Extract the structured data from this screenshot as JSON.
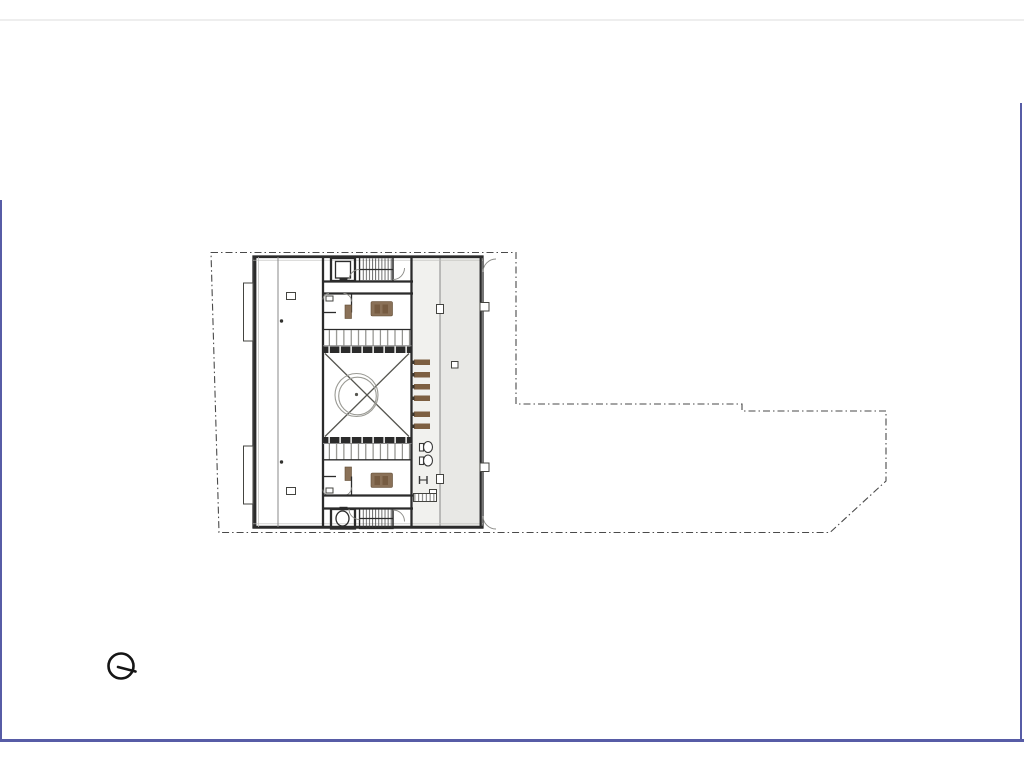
{
  "canvas": {
    "width": 1024,
    "height": 768,
    "background": "#ffffff"
  },
  "colors": {
    "page_bg": "#ffffff",
    "page_border": "#575ca6",
    "top_rule": "#eeeeee",
    "wall": "#2b2b2b",
    "boundary_line": "#4a4a4a",
    "corridor_fill": "#e8e8e5",
    "walkway_fill": "#f1f1ee",
    "stair_fill": "#d8d8d4",
    "furniture_wood": "#8a7158",
    "furniture_wood_dark": "#66492f",
    "bench_wood": "#7d5f41",
    "detail_line": "#888888",
    "compass_ink": "#151515"
  },
  "compass": {
    "icon": "north-indicator-icon"
  },
  "plan": {
    "type": "architectural-floor-plan",
    "elements": [
      "site-boundary",
      "building-shell",
      "west-gallery-walkway",
      "apartment-unit-top",
      "apartment-unit-bottom",
      "elevator-top",
      "stair-top",
      "elevator-bottom",
      "stair-bottom",
      "courtyard-atrium",
      "east-corridor",
      "bench-row",
      "deck-louvers",
      "grille-bands"
    ]
  }
}
